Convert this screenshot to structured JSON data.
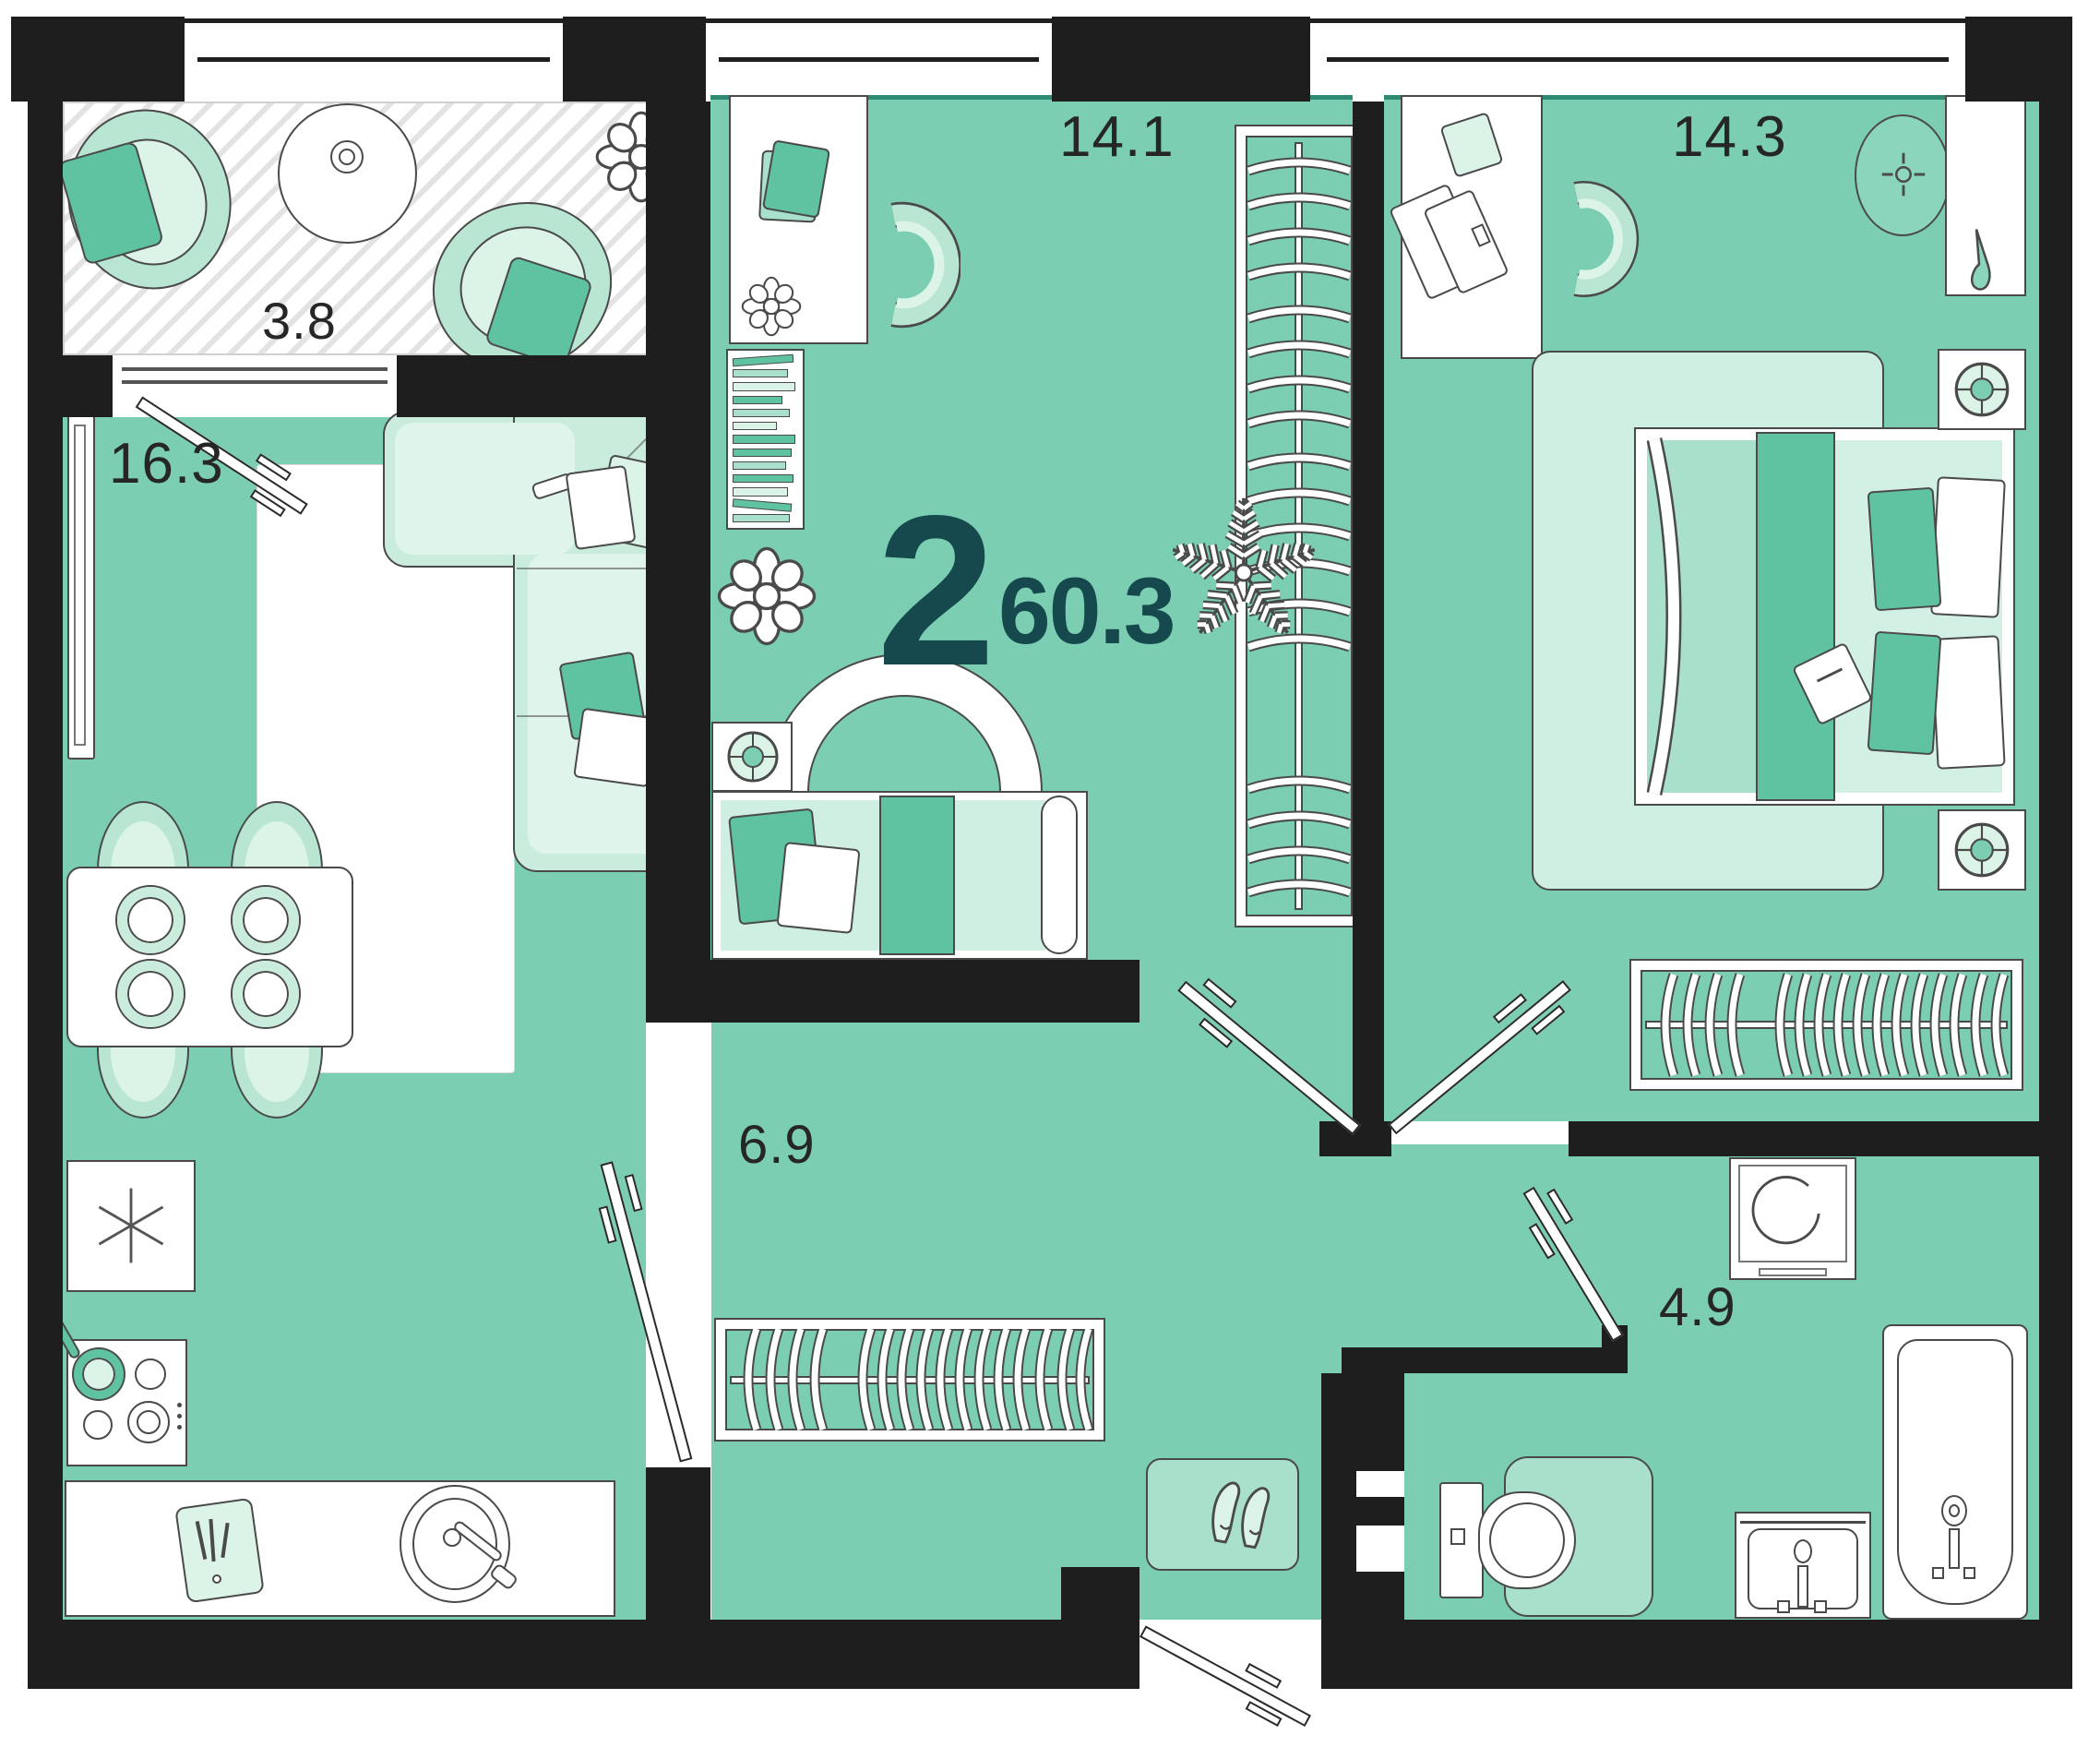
{
  "summary": {
    "room_count": "2",
    "total_area": "60.3"
  },
  "rooms": {
    "balcony": {
      "area": "3.8"
    },
    "living": {
      "area": "16.3"
    },
    "room1": {
      "area": "14.1"
    },
    "bedroom": {
      "area": "14.3"
    },
    "hallway": {
      "area": "6.9"
    },
    "bathroom": {
      "area": "4.9"
    }
  },
  "colors": {
    "wall": "#1E1E1E",
    "floor": "#7BCEB2",
    "lite": "#B9E6D2",
    "liter": "#DCF3E8",
    "mid": "#A9E0CC",
    "accent": "#5FC3A2",
    "line": "#4A4A4A",
    "dark": "#16494D",
    "labelc": "#262626",
    "hatch": "#E3E3E3",
    "sill": "#2F8A74"
  }
}
